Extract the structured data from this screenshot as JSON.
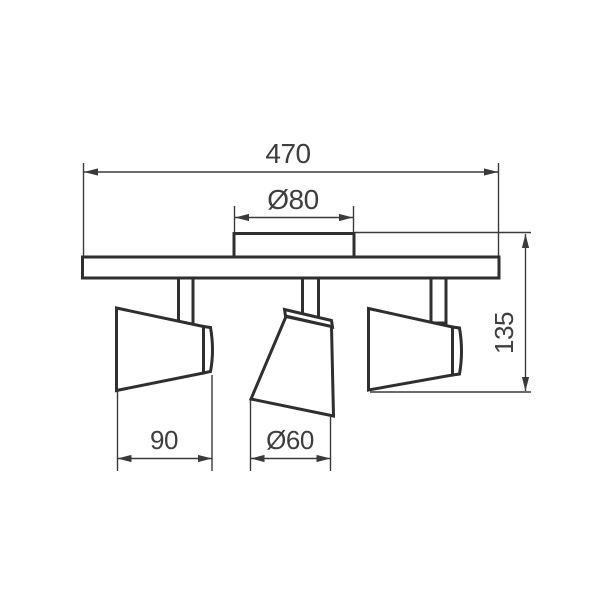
{
  "drawing": {
    "labels": {
      "total_width": "470",
      "canopy_diameter": "Ø80",
      "total_height": "135",
      "head_width": "90",
      "head_diameter": "Ø60"
    },
    "colors": {
      "outline": "#2f2f2f",
      "dimension_lines": "#3a3a3a",
      "label_text": "#3e3e3e",
      "background": "#ffffff"
    }
  }
}
